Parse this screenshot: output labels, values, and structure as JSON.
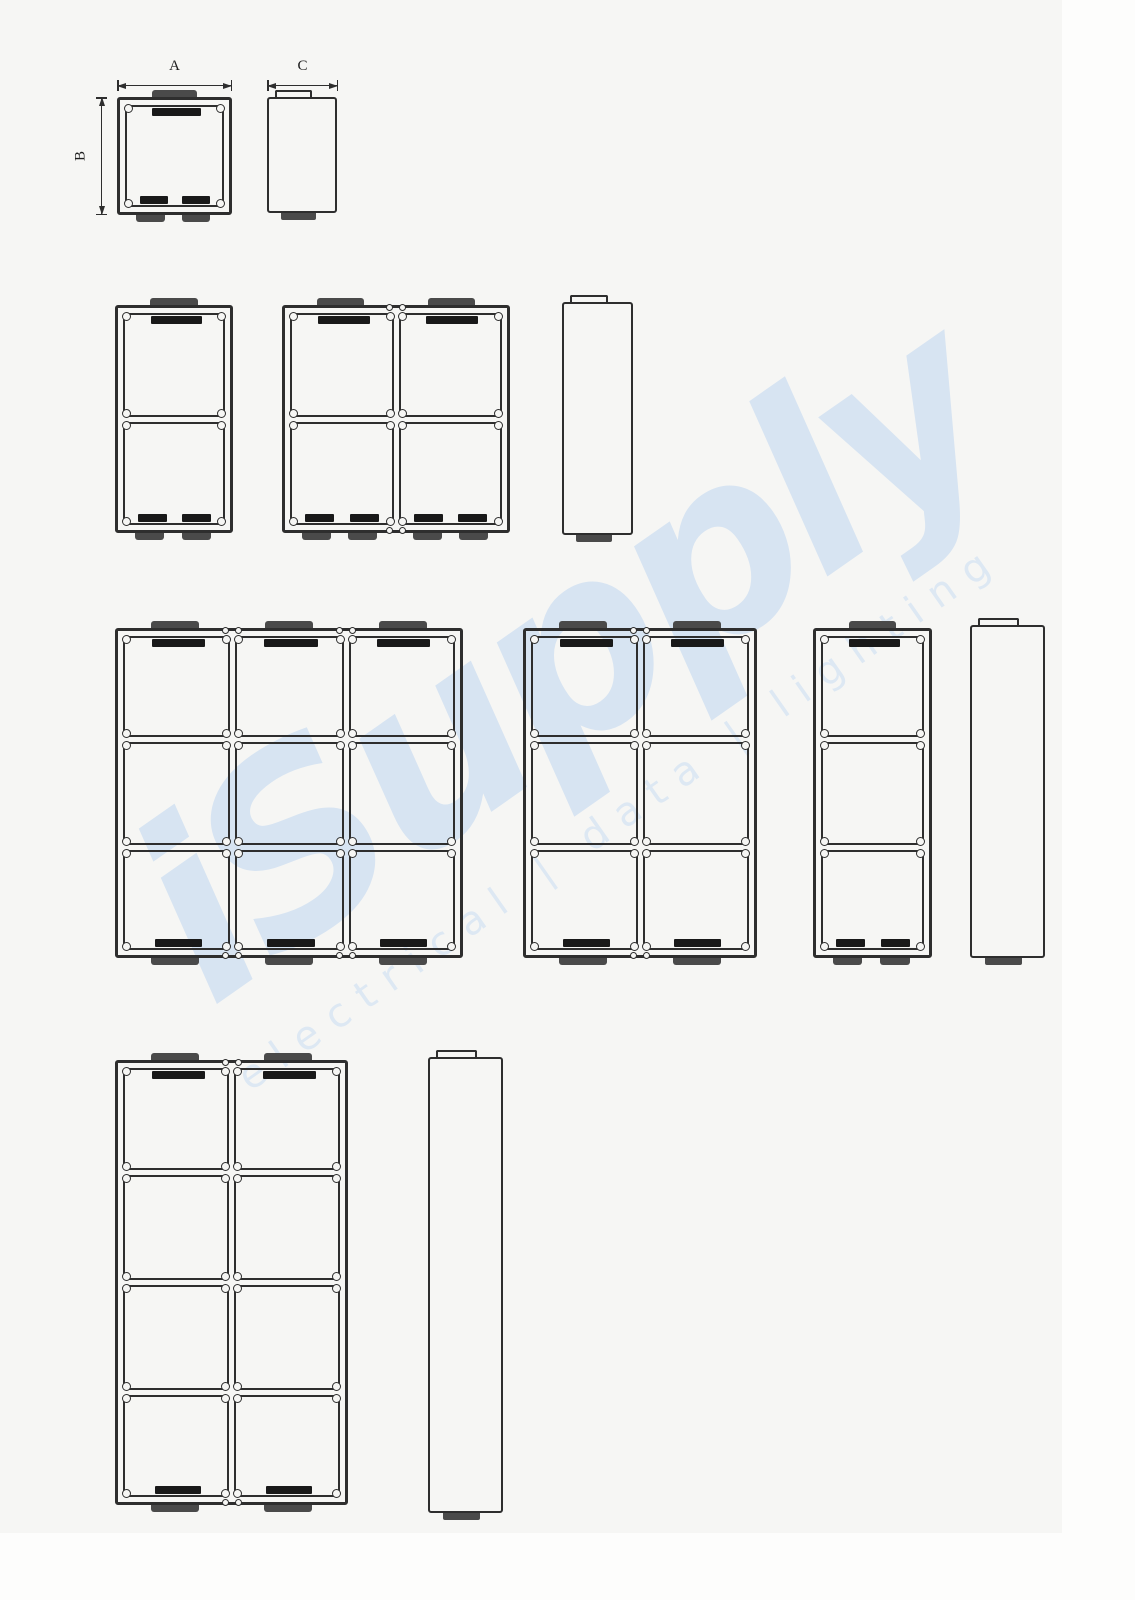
{
  "page": {
    "background": "#f6f6f4",
    "line_color": "#2e2e2e",
    "tab_color": "#4a4a4a",
    "slot_color": "#191919",
    "watermark_color": "#d7e4f2",
    "watermark_color_light": "#dde8f3"
  },
  "dimension_labels": {
    "width": "A",
    "height": "B",
    "depth": "C"
  },
  "watermark": {
    "brand": "iSupply",
    "tagline": "electrical | data | lighting"
  },
  "figures": {
    "boxes": [
      {
        "name": "front-view-1-gang",
        "x": 117,
        "y": 97,
        "w": 115,
        "h": 118,
        "cols": 1,
        "rows": 1,
        "bottom_pairs": true
      },
      {
        "name": "frame-1x2",
        "x": 115,
        "y": 305,
        "w": 118,
        "h": 228,
        "cols": 1,
        "rows": 2,
        "bottom_pairs": true
      },
      {
        "name": "frame-2x2",
        "x": 282,
        "y": 305,
        "w": 228,
        "h": 228,
        "cols": 2,
        "rows": 2,
        "bottom_pairs": true
      },
      {
        "name": "frame-3x3",
        "x": 115,
        "y": 628,
        "w": 348,
        "h": 330,
        "cols": 3,
        "rows": 3,
        "bottom_pairs": false
      },
      {
        "name": "frame-2x3",
        "x": 523,
        "y": 628,
        "w": 234,
        "h": 330,
        "cols": 2,
        "rows": 3,
        "bottom_pairs": false
      },
      {
        "name": "frame-1x3",
        "x": 813,
        "y": 628,
        "w": 119,
        "h": 330,
        "cols": 1,
        "rows": 3,
        "bottom_pairs": true
      },
      {
        "name": "frame-2x4",
        "x": 115,
        "y": 1060,
        "w": 233,
        "h": 445,
        "cols": 2,
        "rows": 4,
        "bottom_pairs": false
      }
    ],
    "side_views": [
      {
        "name": "side-view-1-gang",
        "x": 267,
        "y": 97,
        "w": 70,
        "h": 116
      },
      {
        "name": "side-view-2-high",
        "x": 562,
        "y": 302,
        "w": 71,
        "h": 233
      },
      {
        "name": "side-view-3-high",
        "x": 970,
        "y": 625,
        "w": 75,
        "h": 333
      },
      {
        "name": "side-view-4-high",
        "x": 428,
        "y": 1057,
        "w": 75,
        "h": 456
      }
    ]
  }
}
